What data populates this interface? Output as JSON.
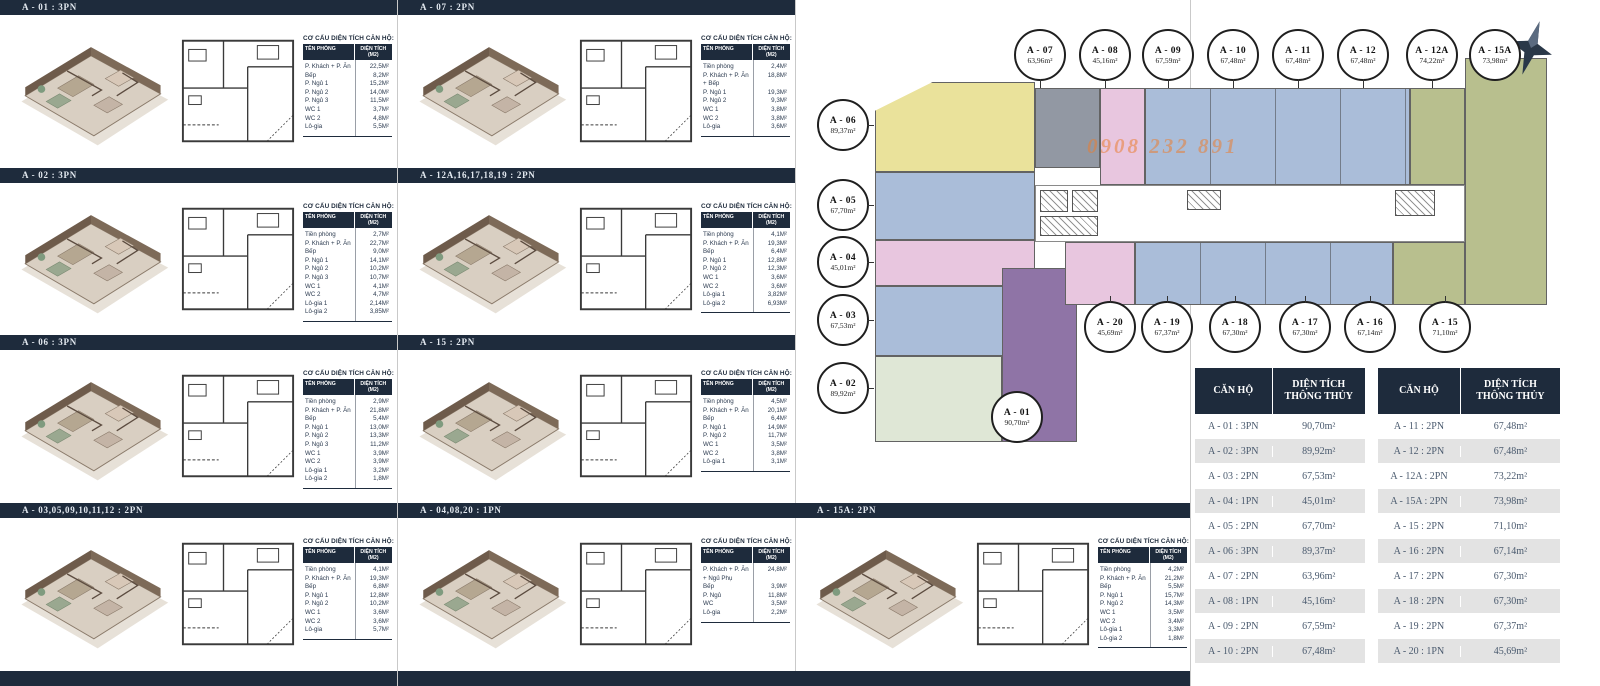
{
  "labels": {
    "area_title": "CƠ CẤU DIỆN TÍCH CĂN HỘ:",
    "area_col1": "TÊN PHÒNG",
    "area_col2": "DIỆN TÍCH (M2)"
  },
  "sections": [
    {
      "header": "A - 01 : 3PN",
      "rows": [
        [
          "P. Khách + P. Ăn",
          "22,5M²"
        ],
        [
          "Bếp",
          "8,2M²"
        ],
        [
          "P. Ngủ 1",
          "15,2M²"
        ],
        [
          "P. Ngủ 2",
          "14,0M²"
        ],
        [
          "P. Ngủ 3",
          "11,5M²"
        ],
        [
          "WC 1",
          "3,7M²"
        ],
        [
          "WC 2",
          "4,8M²"
        ],
        [
          "Lô-gia",
          "5,5M²"
        ]
      ]
    },
    {
      "header": "A - 02 : 3PN",
      "rows": [
        [
          "Tiền phòng",
          "2,7M²"
        ],
        [
          "P. Khách + P. Ăn",
          "22,7M²"
        ],
        [
          "Bếp",
          "9,0M²"
        ],
        [
          "P. Ngủ 1",
          "14,1M²"
        ],
        [
          "P. Ngủ 2",
          "10,2M²"
        ],
        [
          "P. Ngủ 3",
          "10,7M²"
        ],
        [
          "WC 1",
          "4,1M²"
        ],
        [
          "WC 2",
          "4,7M²"
        ],
        [
          "Lô-gia 1",
          "2,14M²"
        ],
        [
          "Lô-gia 2",
          "3,85M²"
        ]
      ]
    },
    {
      "header": "A - 06 : 3PN",
      "rows": [
        [
          "Tiền phòng",
          "2,9M²"
        ],
        [
          "P. Khách + P. Ăn",
          "21,8M²"
        ],
        [
          "Bếp",
          "5,4M²"
        ],
        [
          "P. Ngủ 1",
          "13,0M²"
        ],
        [
          "P. Ngủ 2",
          "13,3M²"
        ],
        [
          "P. Ngủ 3",
          "11,2M²"
        ],
        [
          "WC 1",
          "3,9M²"
        ],
        [
          "WC 2",
          "3,9M²"
        ],
        [
          "Lô-gia 1",
          "3,2M²"
        ],
        [
          "Lô-gia 2",
          "1,8M²"
        ]
      ]
    },
    {
      "header": "A - 03,05,09,10,11,12 : 2PN",
      "rows": [
        [
          "Tiền phòng",
          "4,1M²"
        ],
        [
          "P. Khách + P. Ăn",
          "19,3M²"
        ],
        [
          "Bếp",
          "6,8M²"
        ],
        [
          "P. Ngủ 1",
          "12,8M²"
        ],
        [
          "P. Ngủ 2",
          "10,2M²"
        ],
        [
          "WC 1",
          "3,6M²"
        ],
        [
          "WC 2",
          "3,6M²"
        ],
        [
          "Lô-gia",
          "5,7M²"
        ]
      ]
    },
    {
      "header": "A - 07 : 2PN",
      "rows": [
        [
          "Tiền phòng",
          "2,4M²"
        ],
        [
          "P. Khách + P. Ăn + Bếp",
          "18,8M²"
        ],
        [
          "P. Ngủ 1",
          "19,3M²"
        ],
        [
          "P. Ngủ 2",
          "9,3M²"
        ],
        [
          "WC 1",
          "3,8M²"
        ],
        [
          "WC 2",
          "3,8M²"
        ],
        [
          "Lô-gia",
          "3,6M²"
        ]
      ]
    },
    {
      "header": "A - 12A,16,17,18,19 : 2PN",
      "rows": [
        [
          "Tiền phòng",
          "4,1M²"
        ],
        [
          "P. Khách + P. Ăn",
          "19,3M²"
        ],
        [
          "Bếp",
          "6,4M²"
        ],
        [
          "P. Ngủ 1",
          "12,8M²"
        ],
        [
          "P. Ngủ 2",
          "12,3M²"
        ],
        [
          "WC 1",
          "3,6M²"
        ],
        [
          "WC 2",
          "3,6M²"
        ],
        [
          "Lô-gia 1",
          "3,82M²"
        ],
        [
          "Lô-gia 2",
          "6,93M²"
        ]
      ]
    },
    {
      "header": "A - 15 : 2PN",
      "rows": [
        [
          "Tiền phòng",
          "4,5M²"
        ],
        [
          "P. Khách + P. Ăn",
          "20,1M²"
        ],
        [
          "Bếp",
          "6,4M²"
        ],
        [
          "P. Ngủ 1",
          "14,9M²"
        ],
        [
          "P. Ngủ 2",
          "11,7M²"
        ],
        [
          "WC 1",
          "3,5M²"
        ],
        [
          "WC 2",
          "3,8M²"
        ],
        [
          "Lô-gia 1",
          "3,1M²"
        ]
      ]
    },
    {
      "header": "A - 04,08,20 : 1PN",
      "rows": [
        [
          "P. Khách + P. Ăn + Ngủ Phụ",
          "24,8M²"
        ],
        [
          "Bếp",
          "3,9M²"
        ],
        [
          "P. Ngủ",
          "11,8M²"
        ],
        [
          "WC",
          "3,5M²"
        ],
        [
          "Lô-gia",
          "2,2M²"
        ]
      ]
    },
    {
      "header": "A - 15A: 2PN",
      "rows": [
        [
          "Tiền phòng",
          "4,2M²"
        ],
        [
          "P. Khách + P. Ăn",
          "21,2M²"
        ],
        [
          "Bếp",
          "5,5M²"
        ],
        [
          "P. Ngủ 1",
          "15,7M²"
        ],
        [
          "P. Ngủ 2",
          "14,3M²"
        ],
        [
          "WC 1",
          "3,5M²"
        ],
        [
          "WC 2",
          "3,4M²"
        ],
        [
          "Lô-gia 1",
          "3,3M²"
        ],
        [
          "Lô-gia 2",
          "1,8M²"
        ]
      ]
    }
  ],
  "masterplan": {
    "watermark": "0908 232 891",
    "circles": {
      "a07": {
        "code": "A - 07",
        "area": "63,96m²"
      },
      "a08": {
        "code": "A - 08",
        "area": "45,16m²"
      },
      "a09": {
        "code": "A - 09",
        "area": "67,59m²"
      },
      "a10": {
        "code": "A - 10",
        "area": "67,48m²"
      },
      "a11": {
        "code": "A - 11",
        "area": "67,48m²"
      },
      "a12": {
        "code": "A - 12",
        "area": "67,48m²"
      },
      "a12a": {
        "code": "A - 12A",
        "area": "74,22m²"
      },
      "a15a": {
        "code": "A - 15A",
        "area": "73,98m²"
      },
      "a06": {
        "code": "A - 06",
        "area": "89,37m²"
      },
      "a05": {
        "code": "A - 05",
        "area": "67,70m²"
      },
      "a04": {
        "code": "A - 04",
        "area": "45,01m²"
      },
      "a03": {
        "code": "A - 03",
        "area": "67,53m²"
      },
      "a02": {
        "code": "A - 02",
        "area": "89,92m²"
      },
      "a01": {
        "code": "A - 01",
        "area": "90,70m²"
      },
      "a20": {
        "code": "A - 20",
        "area": "45,69m²"
      },
      "a19": {
        "code": "A - 19",
        "area": "67,37m²"
      },
      "a18": {
        "code": "A - 18",
        "area": "67,30m²"
      },
      "a17": {
        "code": "A - 17",
        "area": "67,30m²"
      },
      "a16": {
        "code": "A - 16",
        "area": "67,14m²"
      },
      "a15": {
        "code": "A - 15",
        "area": "71,10m²"
      }
    }
  },
  "summary": {
    "col1": "CĂN HỘ",
    "col2": "DIỆN TÍCH THÔNG THỦY",
    "tables": [
      {
        "rows": [
          [
            "A - 01 : 3PN",
            "90,70m²"
          ],
          [
            "A - 02 : 3PN",
            "89,92m²"
          ],
          [
            "A - 03 : 2PN",
            "67,53m²"
          ],
          [
            "A - 04 : 1PN",
            "45,01m²"
          ],
          [
            "A - 05 : 2PN",
            "67,70m²"
          ],
          [
            "A - 06 : 3PN",
            "89,37m²"
          ],
          [
            "A - 07 : 2PN",
            "63,96m²"
          ],
          [
            "A - 08 : 1PN",
            "45,16m²"
          ],
          [
            "A - 09 : 2PN",
            "67,59m²"
          ],
          [
            "A - 10 : 2PN",
            "67,48m²"
          ]
        ]
      },
      {
        "rows": [
          [
            "A - 11 : 2PN",
            "67,48m²"
          ],
          [
            "A - 12 : 2PN",
            "67,48m²"
          ],
          [
            "A - 12A : 2PN",
            "73,22m²"
          ],
          [
            "A - 15A : 2PN",
            "73,98m²"
          ],
          [
            "A - 15 : 2PN",
            "71,10m²"
          ],
          [
            "A - 16 : 2PN",
            "67,14m²"
          ],
          [
            "A - 17 : 2PN",
            "67,30m²"
          ],
          [
            "A - 18 : 2PN",
            "67,30m²"
          ],
          [
            "A - 19 : 2PN",
            "67,37m²"
          ],
          [
            "A - 20 : 1PN",
            "45,69m²"
          ]
        ]
      }
    ]
  },
  "colors": {
    "navy": "#1e2b3c",
    "unit_yellow": "#eae29b",
    "unit_blue": "#aabdd9",
    "unit_pink": "#e8c6df",
    "unit_green": "#dfe7d6",
    "unit_purple": "#8f74a6",
    "unit_gray": "#9298a3",
    "unit_olive": "#b8bf8e",
    "watermark_orange": "#e97e32"
  }
}
